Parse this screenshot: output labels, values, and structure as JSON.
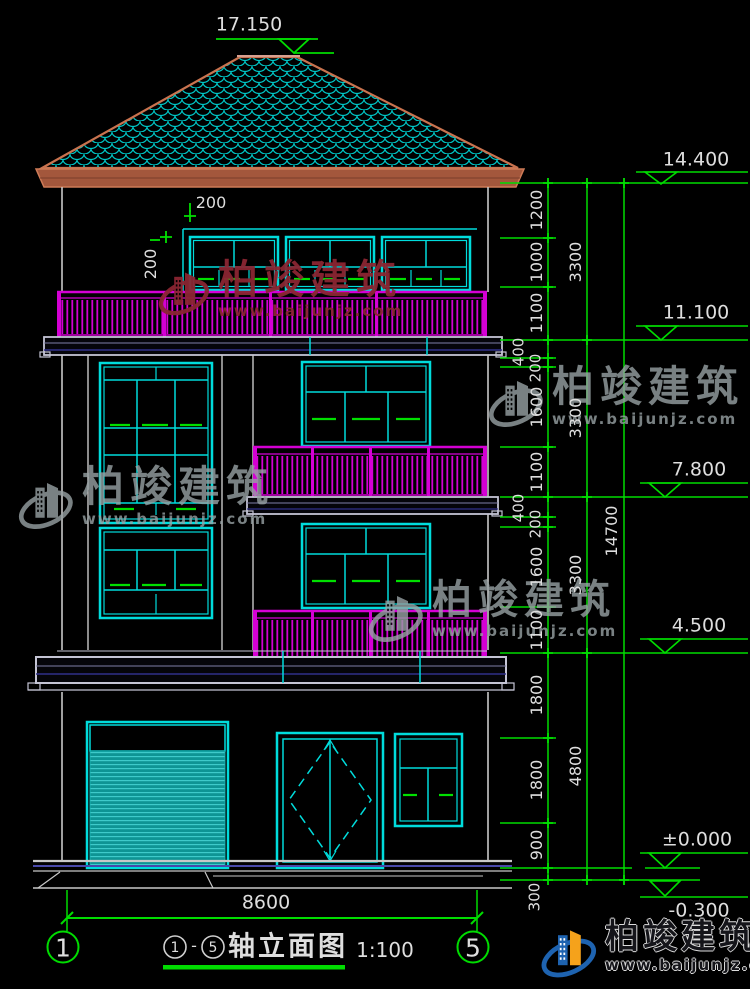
{
  "colors": {
    "cyan": "#00DCDC",
    "magenta": "#D400D4",
    "green": "#00DC00",
    "white": "#C9C9C9",
    "roof_edge": "#C9734F",
    "roof_fill": "#A3573C",
    "teal_fill": "#0E9494",
    "wm_gray": "#98A2A4",
    "wm_red": "#8B2532",
    "logo_blue": "#1E63B0",
    "logo_orange": "#F5A21B"
  },
  "elevations": {
    "ridge": "17.150",
    "eave": "14.400",
    "level3": "11.100",
    "level2": "7.800",
    "level1": "4.500",
    "zero": "±0.000",
    "site": "-0.300"
  },
  "dims": {
    "overall_width": "8600",
    "right_total": "14700",
    "right_groups": [
      "3300",
      "3300",
      "3300",
      "4800"
    ],
    "right_detail": [
      "1200",
      "1000",
      "1100",
      "400",
      "200",
      "1600",
      "1100",
      "400",
      "200",
      "1600",
      "1100",
      "1800",
      "1800",
      "900",
      "300"
    ],
    "parapet_h": "200",
    "parapet_v": "200"
  },
  "axes": {
    "left": "1",
    "right": "5"
  },
  "title": {
    "start": "1",
    "sep": "-",
    "end": "5",
    "name": "轴立面图",
    "scale": "1:100"
  },
  "watermark": {
    "brand": "柏竣建筑",
    "url": "www.baijunjz.com"
  }
}
